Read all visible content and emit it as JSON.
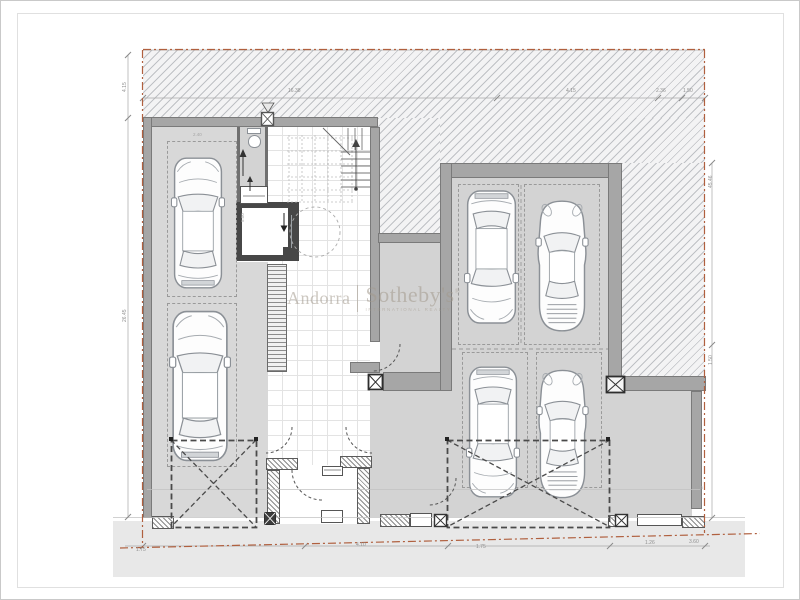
{
  "watermark": {
    "region": "Andorra",
    "divider": "|",
    "brand": "Sotheby's",
    "registered": "®",
    "tagline": "INTERNATIONAL REALTY",
    "color": "#a39a8d"
  },
  "dimensions": {
    "top": [
      "16.38",
      "4.15",
      "2.36",
      "1.50"
    ],
    "left": [
      "4.15",
      "26.45"
    ],
    "right": [
      "45.46",
      "1.50",
      "7.26"
    ],
    "bottom": [
      "1.75",
      "4.10",
      "1.75",
      "1.26",
      "3.60"
    ],
    "garage_internal": [
      "2.40",
      "5.00"
    ]
  },
  "colors": {
    "property_line": "#b0603f",
    "wall": "#a6a6a6",
    "wall_outline": "#7a7a7a",
    "elevator_wall": "#474747",
    "floor_garage": "#d8d8d8",
    "floor_hall": "#ffffff",
    "hatch_line": "#a9adb3",
    "sidewalk": "#e8e8e8",
    "dimension_text": "#8f8f8f",
    "car_outline": "#8b9096",
    "dashed_marks": "#555555"
  },
  "icons": {
    "column_marker": "x-square",
    "survey_marker": "triangle",
    "door_swing": "quarter-arc",
    "garage_door_zone": "dashed-x-rect",
    "toilet": "wc-plan-symbol",
    "elevator_arrow": "down-arrow",
    "corridor_arrow": "up-arrow",
    "stairs": "plan-steps"
  }
}
